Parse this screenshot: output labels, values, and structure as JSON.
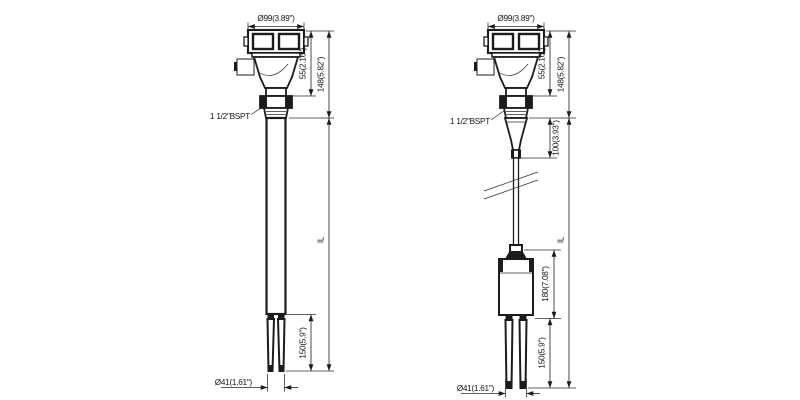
{
  "drawing": {
    "rod_version": {
      "top_diameter": "Ø99(3.89\")",
      "housing_height": "55(2.16\")",
      "head_height": "148(5.82\")",
      "process_connection": "1 1/2\"BSPT",
      "insertion_length": "IL",
      "fork_length": "150(5.9\")",
      "fork_diameter": "Ø41(1.61\")"
    },
    "cable_version": {
      "top_diameter": "Ø99(3.89\")",
      "housing_height": "55(2.16\")",
      "head_height": "148(5.82\")",
      "process_connection": "1 1/2\"BSPT",
      "extension_length": "100(3.93\")",
      "insertion_length": "IL",
      "weight_length": "180(7.08\")",
      "fork_length": "150(5.9\")",
      "fork_diameter": "Ø41(1.61\")"
    },
    "colors": {
      "line": "#1c1c1c",
      "background": "#ffffff"
    }
  }
}
